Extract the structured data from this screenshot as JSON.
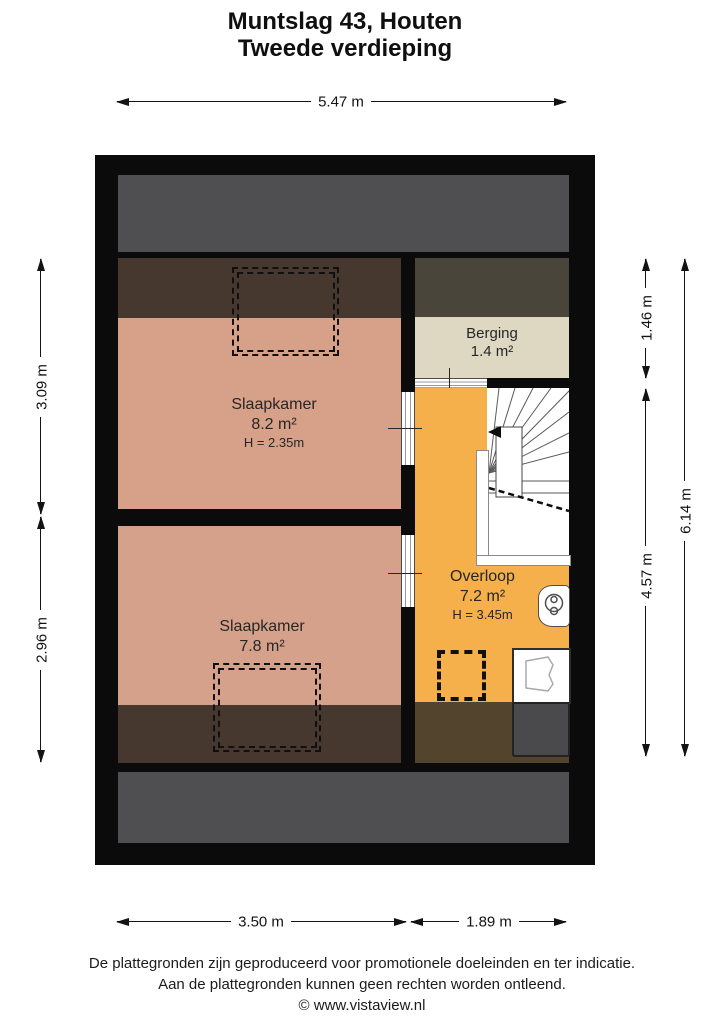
{
  "title": {
    "line1": "Muntslag 43, Houten",
    "line2": "Tweede verdieping"
  },
  "dimensions": {
    "width_total": "5.47 m",
    "left_top": "3.09 m",
    "left_bottom": "2.96 m",
    "right_top": "1.46 m",
    "right_middle": "4.57 m",
    "right_total": "6.14 m",
    "bottom_left": "3.50 m",
    "bottom_right": "1.89 m"
  },
  "rooms": [
    {
      "name": "Slaapkamer",
      "area": "8.2 m²",
      "ceiling_height": "H = 2.35m"
    },
    {
      "name": "Slaapkamer",
      "area": "7.8 m²"
    },
    {
      "name": "Berging",
      "area": "1.4 m²"
    },
    {
      "name": "Overloop",
      "area": "7.2 m²",
      "ceiling_height": "H = 3.45m"
    }
  ],
  "icons": [
    {
      "name": "stairs-icon",
      "meaning": "winder staircase with up-arrow and headroom dash line"
    },
    {
      "name": "roof-window-icon",
      "meaning": "dashed dormer/roof window outline (two in bedrooms, one in landing)"
    },
    {
      "name": "ventilation-unit-icon",
      "meaning": "mechanical ventilation / boiler unit"
    },
    {
      "name": "sink-icon",
      "meaning": "small wash basin"
    },
    {
      "name": "cabinet-icon",
      "meaning": "dark storage block under roof slope"
    }
  ],
  "colors": {
    "wall_black": "#0b0b0b",
    "roof_gray": "#4f4f51",
    "low_headroom_brown": "#46382f",
    "berging_top_olive": "#49453a",
    "landing_low_brown": "#53452d",
    "bedroom_floor": "#d7a088",
    "berging_floor": "#ded8c3",
    "landing_floor": "#f5b04b"
  },
  "footer": {
    "line1": "De plattegronden zijn geproduceerd voor promotionele doeleinden en ter indicatie.",
    "line2": "Aan de plattegronden kunnen geen rechten worden ontleend.",
    "line3": "© www.vistaview.nl"
  }
}
